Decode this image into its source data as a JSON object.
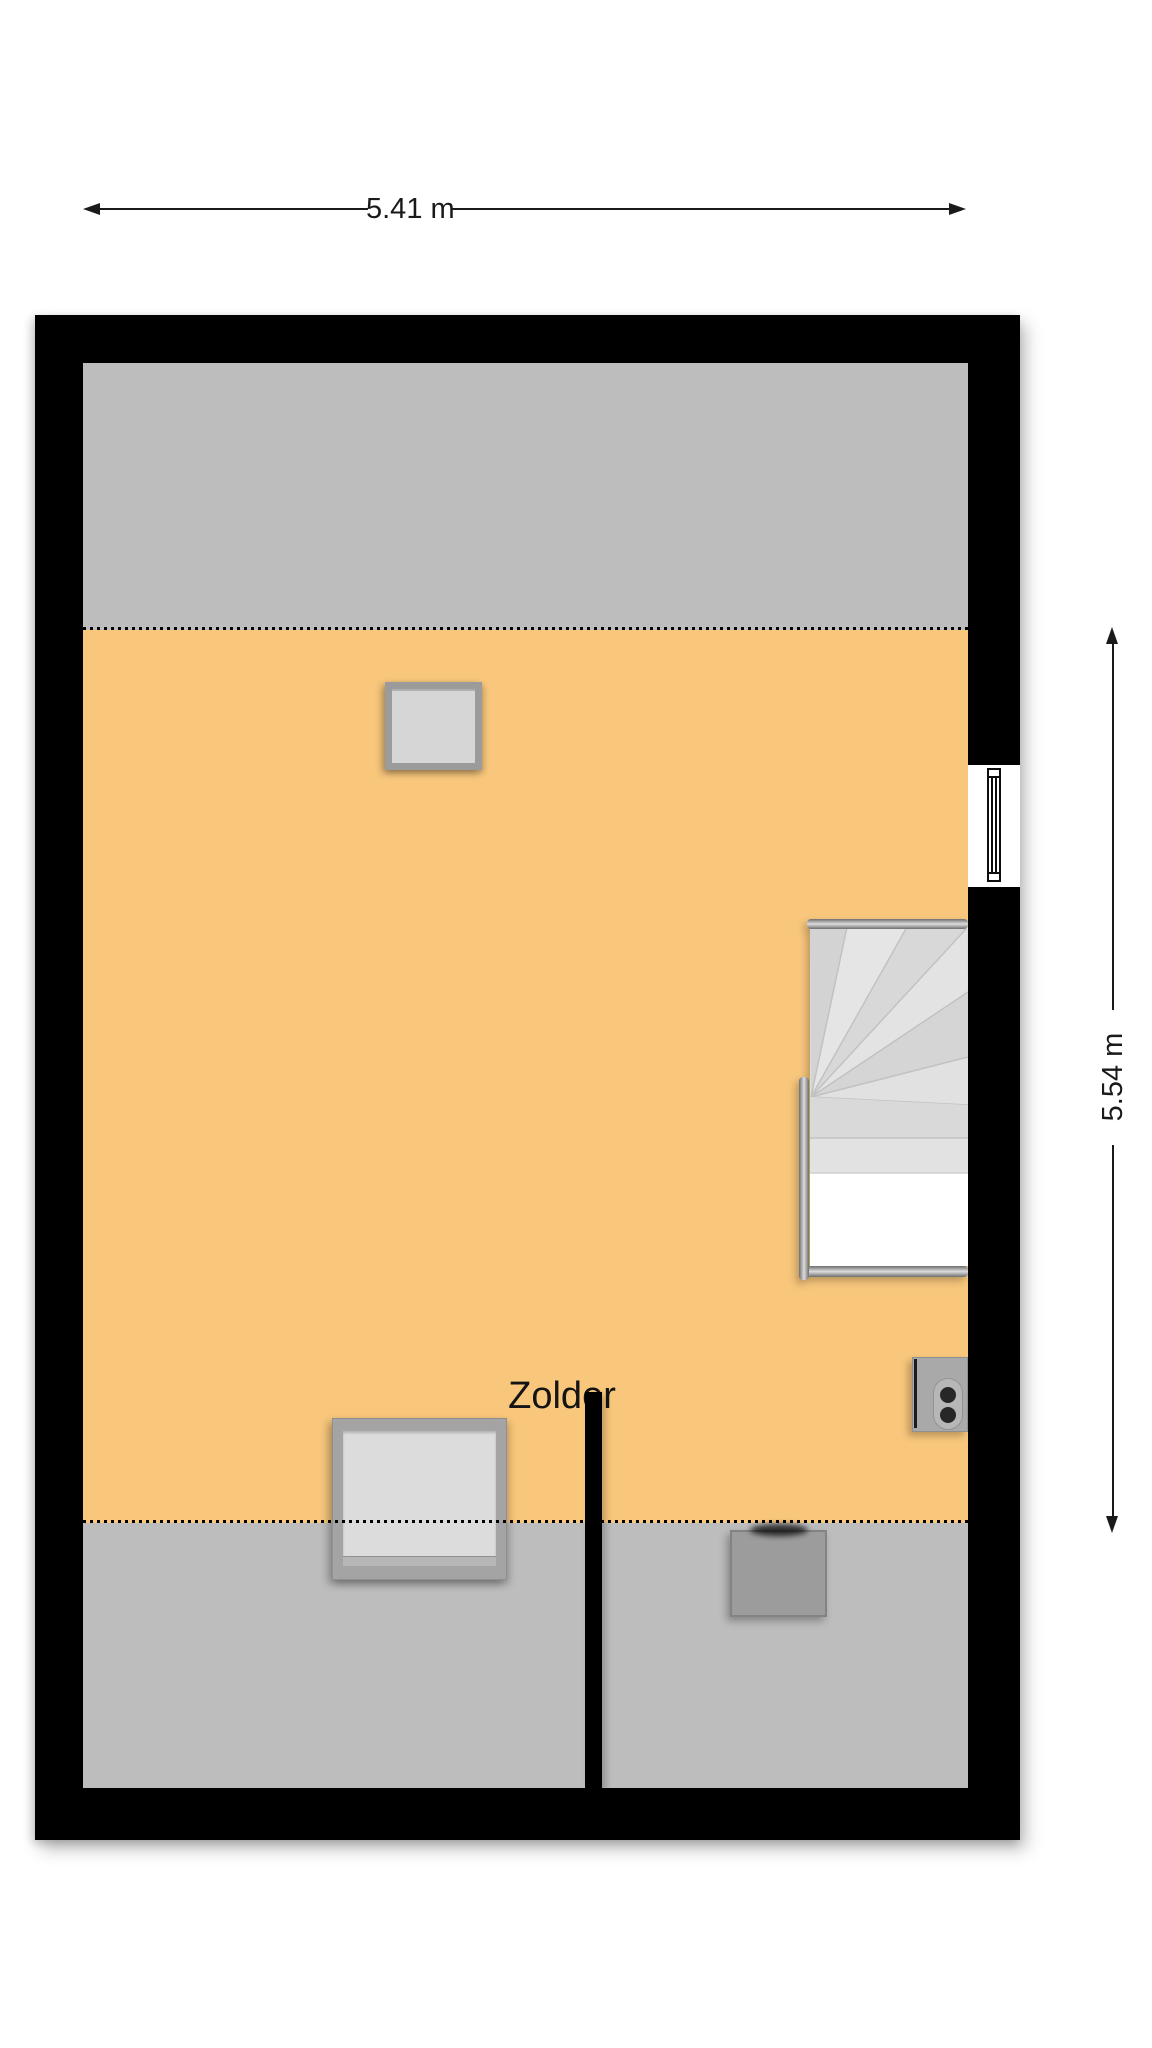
{
  "floorplan": {
    "room_label": "Zolder",
    "dimensions": {
      "width_label": "5.41 m",
      "height_label": "5.54 m"
    },
    "colors": {
      "wall": "#000000",
      "usable_area": "#F8C77C",
      "low_headroom_area": "#BDBDBD",
      "stair_tread": "#DFDFDF",
      "object_gray": "#9C9C9C",
      "background": "#FFFFFF"
    },
    "objects": [
      {
        "name": "roof-window-top"
      },
      {
        "name": "winder-staircase"
      },
      {
        "name": "right-wall-window"
      },
      {
        "name": "ventilation-unit"
      },
      {
        "name": "roof-window-bottom"
      },
      {
        "name": "chimney-duct"
      },
      {
        "name": "partition-wall"
      }
    ]
  }
}
